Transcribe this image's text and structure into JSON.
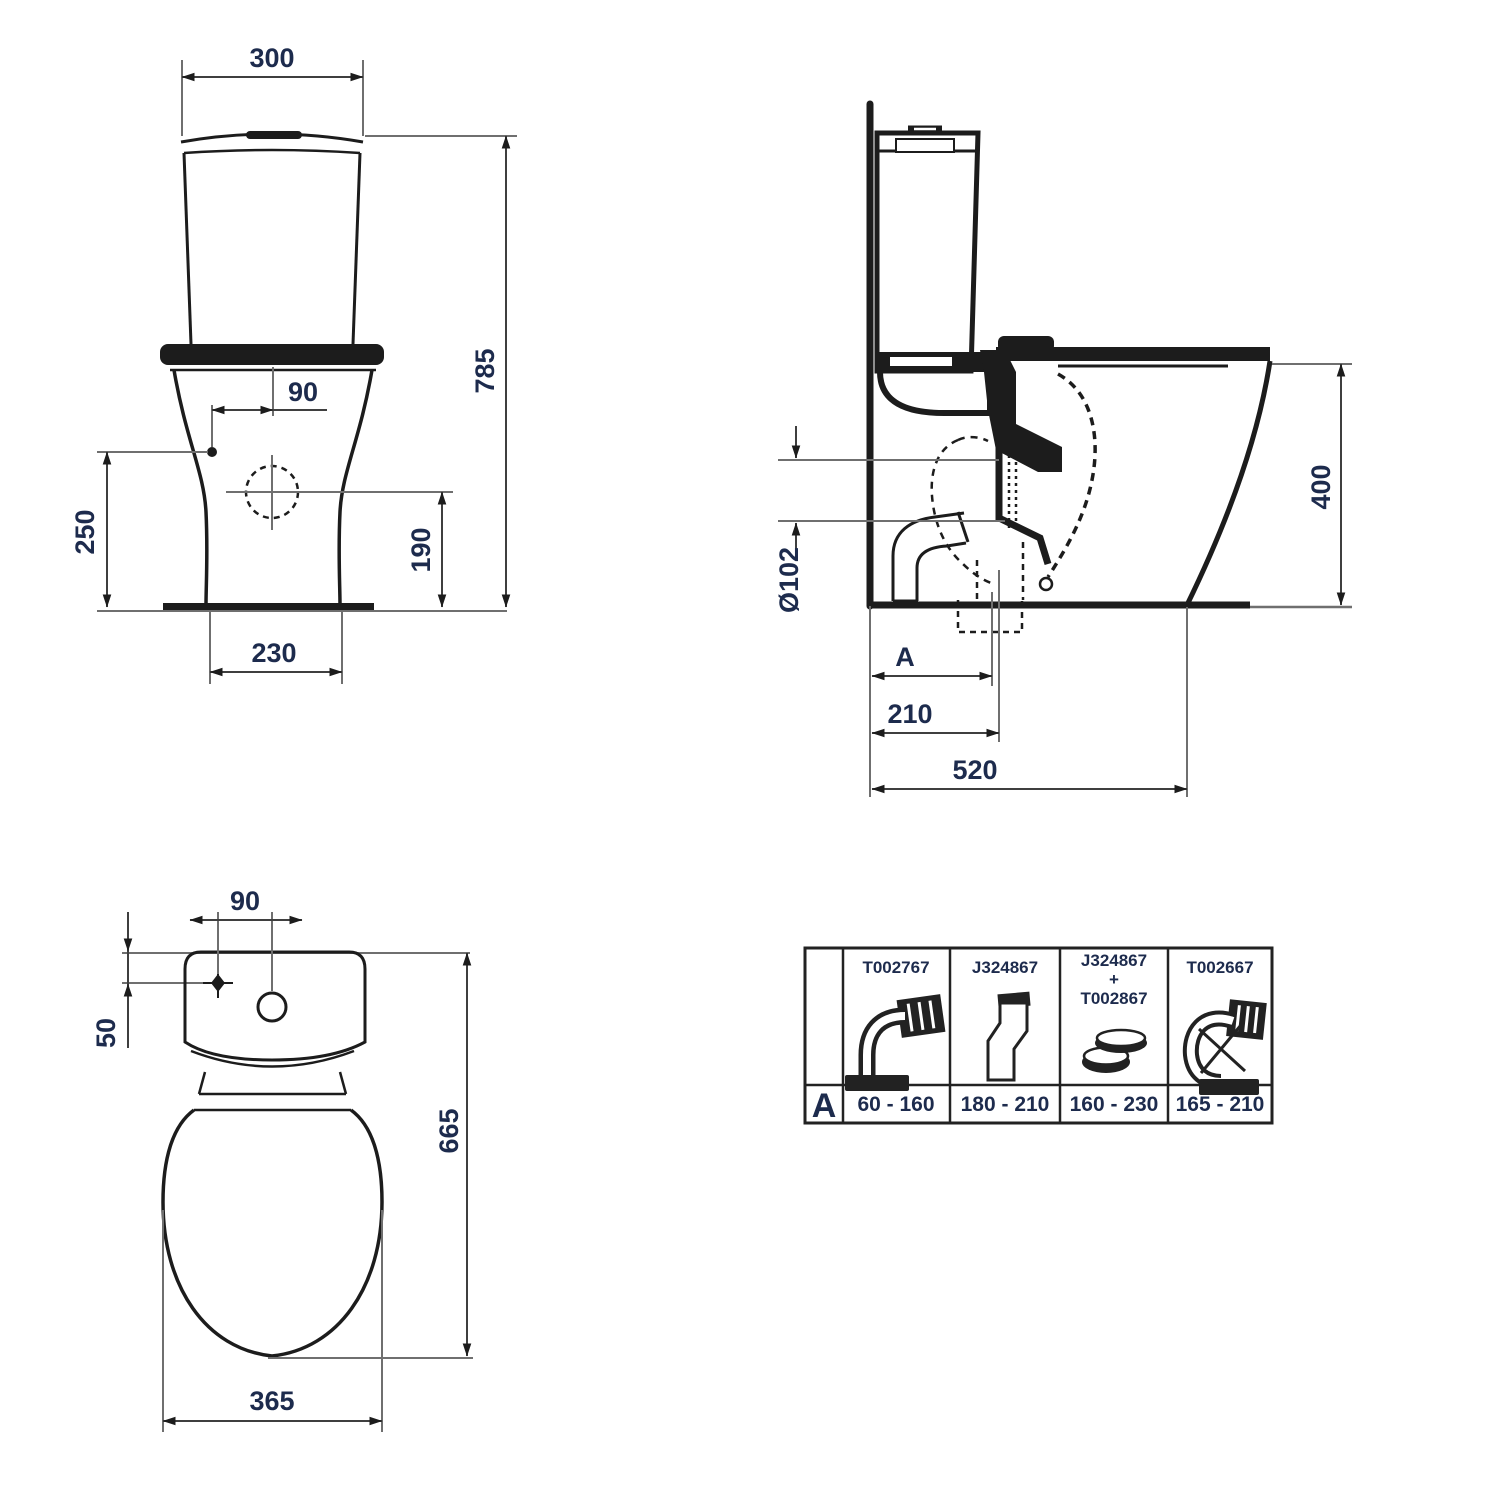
{
  "views": {
    "front": {
      "labels": {
        "width_top": "300",
        "height_total": "785",
        "inlet_offset": "90",
        "inlet_height": "250",
        "outlet_height": "190",
        "base_width": "230"
      }
    },
    "side": {
      "labels": {
        "outlet_diameter": "Ø102",
        "adjust_label": "A",
        "outlet_distance": "210",
        "depth_total": "520",
        "rim_height": "400"
      }
    },
    "plan": {
      "labels": {
        "hole_spacing": "90",
        "hole_offset": "50",
        "length_total": "665",
        "bowl_width": "365"
      }
    }
  },
  "table": {
    "row_label": "A",
    "columns": [
      {
        "code": "T002767",
        "icon": "bent-pan-connector-icon",
        "range": "60 - 160"
      },
      {
        "code": "J324867",
        "icon": "offset-pan-connector-icon",
        "range": "180 - 210"
      },
      {
        "code": "J324867",
        "code_plus": "+",
        "code2": "T002867",
        "icon": "eccentric-ring-connector-icon",
        "range": "160 - 230"
      },
      {
        "code": "T002667",
        "icon": "flexible-bend-connector-icon",
        "range": "165 - 210"
      }
    ]
  }
}
